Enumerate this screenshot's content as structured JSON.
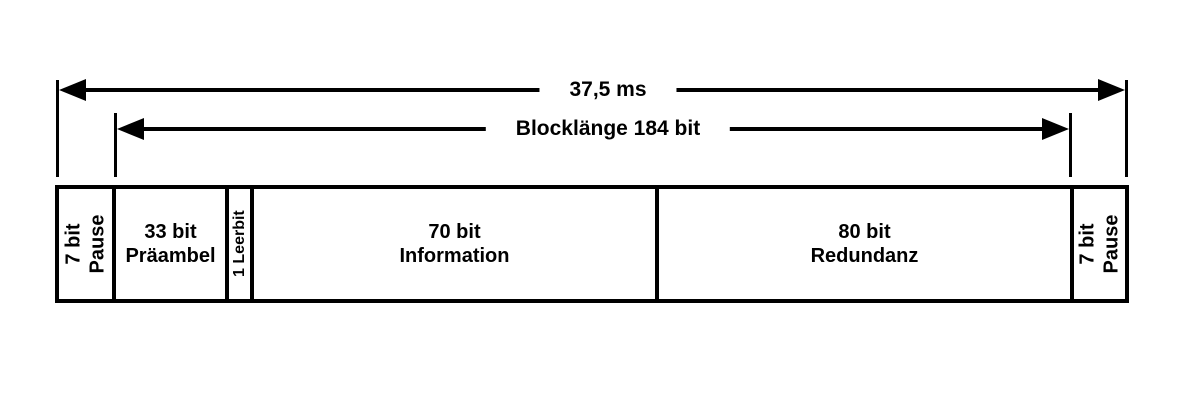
{
  "diagram": {
    "arrows": [
      {
        "name": "total-duration",
        "label": "37,5 ms"
      },
      {
        "name": "block-length",
        "label": "Blocklänge 184 bit"
      }
    ],
    "segments": [
      {
        "name": "pause-left",
        "lines": [
          "7 bit",
          "Pause"
        ],
        "orientation": "vertical"
      },
      {
        "name": "preamble",
        "lines": [
          "33 bit",
          "Präambel"
        ],
        "orientation": "horizontal"
      },
      {
        "name": "spacer-bit",
        "lines": [
          "1 Leerbit"
        ],
        "orientation": "vertical"
      },
      {
        "name": "information",
        "lines": [
          "70 bit",
          "Information"
        ],
        "orientation": "horizontal"
      },
      {
        "name": "redundancy",
        "lines": [
          "80 bit",
          "Redundanz"
        ],
        "orientation": "horizontal"
      },
      {
        "name": "pause-right",
        "lines": [
          "7 bit",
          "Pause"
        ],
        "orientation": "vertical"
      }
    ],
    "colors": {
      "ink": "#000000",
      "background": "#ffffff"
    }
  }
}
